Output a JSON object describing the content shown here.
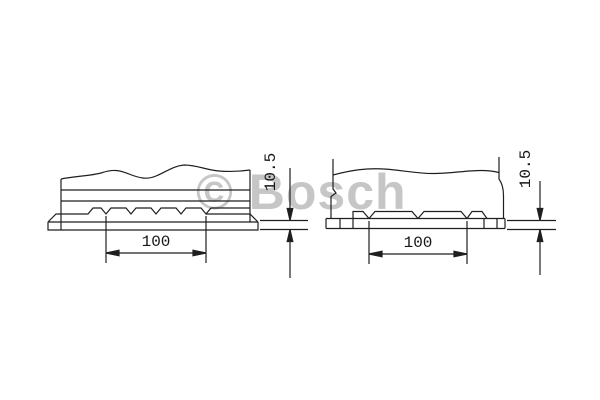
{
  "meta": {
    "background": "#ffffff",
    "stroke_color": "#1f1f1f",
    "watermark_color": "#c6c6c6"
  },
  "watermark": {
    "text": "© Bosch"
  },
  "views": {
    "left": {
      "title": "battery base side view A",
      "width_dim_label": "100",
      "height_dim_label": "10.5"
    },
    "right": {
      "title": "battery base side view B",
      "width_dim_label": "100",
      "height_dim_label": "10.5"
    }
  },
  "drawing": {
    "stroke": "#1f1f1f",
    "stroke_width": 1.2,
    "shapes": [
      {
        "name": "left-body-left-edge",
        "type": "line",
        "x1": 61,
        "y1": 179,
        "x2": 61,
        "y2": 230
      },
      {
        "name": "left-body-right-edge",
        "type": "line",
        "x1": 250,
        "y1": 170,
        "x2": 250,
        "y2": 222
      },
      {
        "name": "left-body-top-wave",
        "type": "path",
        "d": "M61,179 C75,176 90,176 101,173 C113,169 119,170 129,174 C139,178 147,180 156,176 C166,172 173,166 184,165 C197,165 206,170 219,171 C231,172 243,171 250,170"
      },
      {
        "name": "left-body-line-1",
        "type": "line",
        "x1": 61,
        "y1": 190,
        "x2": 250,
        "y2": 190
      },
      {
        "name": "left-body-line-2",
        "type": "line",
        "x1": 61,
        "y1": 201,
        "x2": 250,
        "y2": 201
      },
      {
        "name": "left-ledge-teeth",
        "type": "path",
        "d": "M48,222 L56,214 L88,214 L93,208 L101,208 L106,214 L111,208 L126,208 L131,214 L136,208 L151,208 L156,214 L161,208 L176,208 L181,214 L186,208 L201,208 L206,214 L211,208 L250,208"
      },
      {
        "name": "left-ledge-right-corner",
        "type": "path",
        "d": "M206,214 L250,214 L258,222"
      },
      {
        "name": "left-foot-step-line",
        "type": "line",
        "x1": 48,
        "y1": 222,
        "x2": 258,
        "y2": 222
      },
      {
        "name": "left-foot-outline",
        "type": "path",
        "d": "M48,222 L48,230 L258,230 L258,222"
      },
      {
        "name": "left-ext-line-a",
        "type": "line",
        "x1": 106,
        "y1": 216,
        "x2": 106,
        "y2": 263
      },
      {
        "name": "left-ext-line-b",
        "type": "line",
        "x1": 206,
        "y1": 216,
        "x2": 206,
        "y2": 263
      },
      {
        "name": "left-width-dim-line",
        "type": "line",
        "x1": 106,
        "y1": 253,
        "x2": 206,
        "y2": 253
      },
      {
        "name": "left-width-arrow-left",
        "type": "polygon",
        "points": "106,253 119,250.2 119,255.8"
      },
      {
        "name": "left-width-arrow-right",
        "type": "polygon",
        "points": "206,253 193,250.2 193,255.8"
      },
      {
        "name": "left-ref-line-top",
        "type": "line",
        "x1": 260,
        "y1": 220.5,
        "x2": 308,
        "y2": 220.5
      },
      {
        "name": "left-ref-line-bottom",
        "type": "line",
        "x1": 260,
        "y1": 229.5,
        "x2": 308,
        "y2": 229.5
      },
      {
        "name": "left-height-dim-line-upper",
        "type": "line",
        "x1": 290,
        "y1": 168,
        "x2": 290,
        "y2": 220
      },
      {
        "name": "left-height-dim-line-lower",
        "type": "line",
        "x1": 290,
        "y1": 230,
        "x2": 290,
        "y2": 278
      },
      {
        "name": "left-height-arrow-down",
        "type": "polygon",
        "points": "290,220.5 287.2,208.5 292.8,208.5"
      },
      {
        "name": "left-height-arrow-up",
        "type": "polygon",
        "points": "290,229.5 287.2,241.5 292.8,241.5"
      },
      {
        "name": "right-body-left-edge",
        "type": "path",
        "d": "M333,159 L333,189 L336,193 L331,196.5 L331,218.5"
      },
      {
        "name": "right-body-right-edge",
        "type": "path",
        "d": "M499,157 L499,179 C502,183 503.5,188 503.5,196 L503.5,218.5"
      },
      {
        "name": "right-body-top-wave",
        "type": "path",
        "d": "M333,175 C352,170 366,168 384,169 C401,170 416,173.5 433,173.5 C451,173.5 466,170.5 481,170.5 C489,170.5 495,171.5 499,172.5"
      },
      {
        "name": "right-foot-top",
        "type": "line",
        "x1": 326,
        "y1": 218.5,
        "x2": 505,
        "y2": 218.5
      },
      {
        "name": "right-foot-bottom",
        "type": "line",
        "x1": 326,
        "y1": 228.5,
        "x2": 505,
        "y2": 228.5
      },
      {
        "name": "right-foot-left-edge",
        "type": "line",
        "x1": 326,
        "y1": 218.5,
        "x2": 326,
        "y2": 228.5
      },
      {
        "name": "right-foot-right-edge",
        "type": "line",
        "x1": 505,
        "y1": 218.5,
        "x2": 505,
        "y2": 228.5
      },
      {
        "name": "right-foot-divider-1",
        "type": "line",
        "x1": 340,
        "y1": 218.5,
        "x2": 340,
        "y2": 228.5
      },
      {
        "name": "right-foot-divider-2",
        "type": "line",
        "x1": 484,
        "y1": 218.5,
        "x2": 484,
        "y2": 228.5
      },
      {
        "name": "right-foot-divider-3",
        "type": "line",
        "x1": 497,
        "y1": 218.5,
        "x2": 497,
        "y2": 228.5
      },
      {
        "name": "right-tooth-1",
        "type": "path",
        "d": "M353,228.5 L353,211.5 L363,211.5 L369,218.5"
      },
      {
        "name": "right-tooth-2",
        "type": "path",
        "d": "M369,218.5 L375,211.5 L412,211.5 L418,218.5"
      },
      {
        "name": "right-tooth-3",
        "type": "path",
        "d": "M418,218.5 L424,211.5 L461,211.5 L467,218.5"
      },
      {
        "name": "right-tooth-4",
        "type": "path",
        "d": "M467,218.5 L472,211.5 L482,211.5 L487,218.5"
      },
      {
        "name": "right-ext-line-a",
        "type": "line",
        "x1": 369,
        "y1": 221,
        "x2": 369,
        "y2": 264
      },
      {
        "name": "right-ext-line-b",
        "type": "line",
        "x1": 467,
        "y1": 221,
        "x2": 467,
        "y2": 264
      },
      {
        "name": "right-width-dim-line",
        "type": "line",
        "x1": 369,
        "y1": 254,
        "x2": 467,
        "y2": 254
      },
      {
        "name": "right-width-arrow-left",
        "type": "polygon",
        "points": "369,254 382,251.2 382,256.8"
      },
      {
        "name": "right-width-arrow-right",
        "type": "polygon",
        "points": "467,254 454,251.2 454,256.8"
      },
      {
        "name": "right-ref-line-top",
        "type": "line",
        "x1": 507,
        "y1": 220.5,
        "x2": 556,
        "y2": 220.5
      },
      {
        "name": "right-ref-line-bottom",
        "type": "line",
        "x1": 507,
        "y1": 229.5,
        "x2": 556,
        "y2": 229.5
      },
      {
        "name": "right-height-dim-line-upper",
        "type": "line",
        "x1": 540,
        "y1": 181,
        "x2": 540,
        "y2": 220
      },
      {
        "name": "right-height-dim-line-lower",
        "type": "line",
        "x1": 540,
        "y1": 230,
        "x2": 540,
        "y2": 275
      },
      {
        "name": "right-height-arrow-down",
        "type": "polygon",
        "points": "540,220.5 537.2,208.5 542.8,208.5"
      },
      {
        "name": "right-height-arrow-up",
        "type": "polygon",
        "points": "540,229.5 537.2,241.5 542.8,241.5"
      }
    ]
  }
}
